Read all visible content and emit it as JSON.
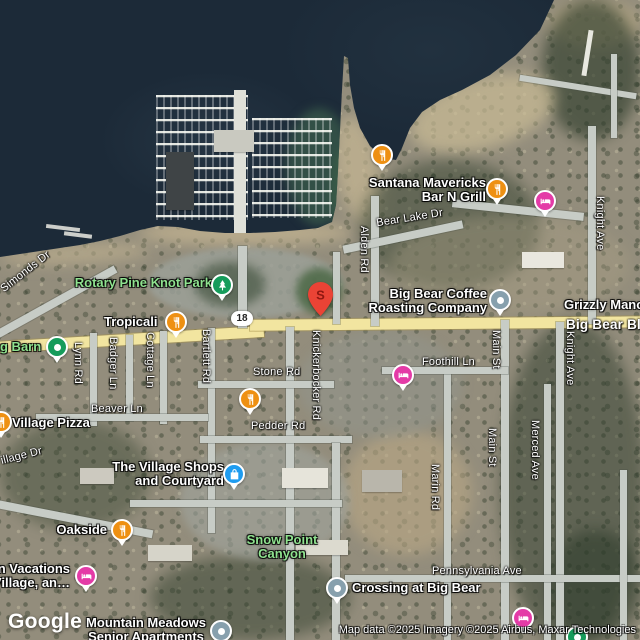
{
  "icons": {
    "restaurant_icon": "fork-and-knife-orange-circle",
    "lodging_icon": "bed-magenta-circle",
    "park_icon": "pine-tree-green-circle",
    "place_pin_icon": "green-circle-white-dot",
    "shopping_icon": "shopping-bag-blue-circle",
    "generic_poi_icon": "gray-circle-white-dot",
    "search_result_pin_icon": "red-teardrop-pin"
  },
  "colors": {
    "restaurant": "#EE9013",
    "lodging": "#E43BA7",
    "park": "#169C5B",
    "shopping": "#1E9CF0",
    "generic_poi": "#87A0AD",
    "search_pin": "#EA4335",
    "green_label": "#8FE28F",
    "highway": "#F2E5A0",
    "water": "#1C2A38"
  },
  "streets": {
    "simonds": "Simonds Dr",
    "bear_lake": "Bear Lake Dr",
    "alden": "Alden Rd",
    "knight": "Knight Ave",
    "knight2": "Knight Ave",
    "main": "Main St",
    "main2": "Main St",
    "merced": "Merced Ave",
    "marin": "Marin Rd",
    "foothill": "Foothill Ln",
    "pennsylvania": "Pennsylvania Ave",
    "knickerbocker": "Knickerbocker Rd",
    "bartlett": "Bartlett Rd",
    "lynn": "Lynn Rd",
    "badger": "Badger Ln",
    "cottage": "Cottage Ln",
    "beaver": "Beaver Ln",
    "stone": "Stone Rd",
    "pedder": "Pedder Rd",
    "village_dr": "illage Dr",
    "big_bear_blvd": "Big Bear Blv",
    "route_18": "18"
  },
  "places": {
    "santana_line1": "Santana Mavericks",
    "santana_line2": "Bar N Grill",
    "rotary_park": "Rotary Pine Knot Park",
    "coffee_line1": "Big Bear Coffee",
    "coffee_line2": "Roasting Company",
    "grizzly": "Grizzly Mano",
    "tropicali": "Tropicali",
    "barn": "g Barn",
    "village_pizza": "Village Pizza",
    "shops_line1": "The Village Shops",
    "shops_line2": "and Courtyard",
    "oakside": "Oakside",
    "snow_line1": "Snow Point",
    "snow_line2": "Canyon",
    "crossing": "Crossing at Big Bear",
    "vacations_line1": "n Vacations",
    "vacations_line2": "Village, an…",
    "meadows_line1": "Mountain Meadows",
    "meadows_line2": "Senior Apartments"
  },
  "marker": {
    "letter": "S"
  },
  "footer": {
    "logo": "Google",
    "attribution": "Map data ©2025 Imagery ©2025 Airbus, Maxar Technologies"
  }
}
